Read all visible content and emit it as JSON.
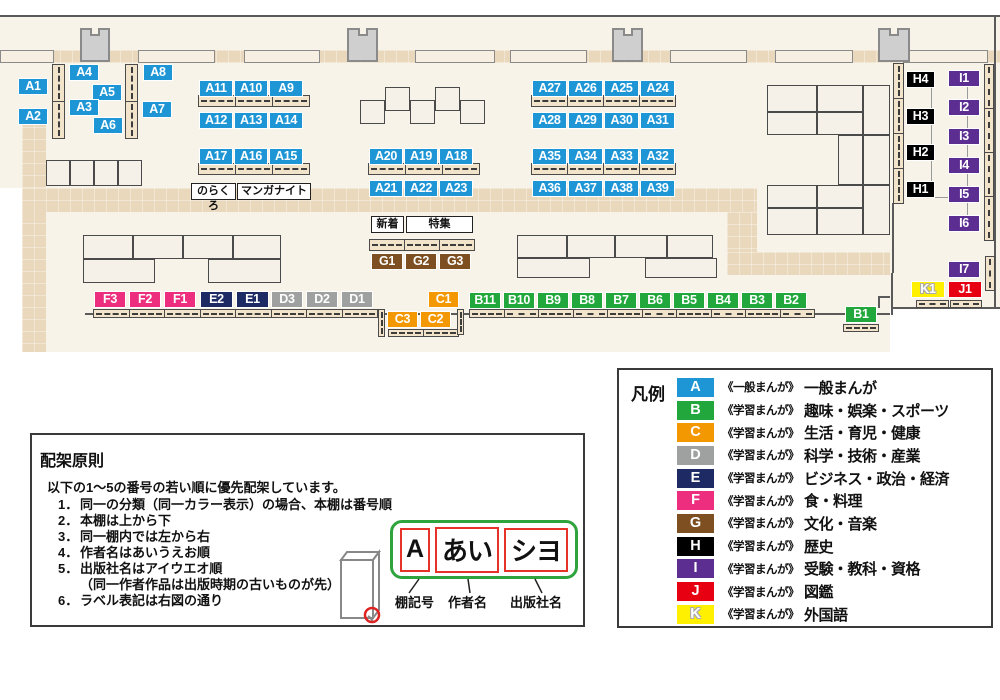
{
  "palette": {
    "A": "#1e95d5",
    "B": "#21a73c",
    "C": "#f39800",
    "D": "#9fa0a0",
    "E": "#1e2a63",
    "F": "#ed2d7d",
    "G": "#7d4f21",
    "H": "#000000",
    "I": "#5d2e91",
    "J": "#e60012",
    "K": "#fff000"
  },
  "map": {
    "shelf_labels": [
      {
        "c": "A1",
        "g": "A",
        "x": 18,
        "y": 78,
        "w": 30
      },
      {
        "c": "A2",
        "g": "A",
        "x": 18,
        "y": 108,
        "w": 30
      },
      {
        "c": "A4",
        "g": "A",
        "x": 69,
        "y": 64,
        "w": 30
      },
      {
        "c": "A5",
        "g": "A",
        "x": 92,
        "y": 84,
        "w": 30
      },
      {
        "c": "A3",
        "g": "A",
        "x": 69,
        "y": 99,
        "w": 30
      },
      {
        "c": "A6",
        "g": "A",
        "x": 93,
        "y": 117,
        "w": 30
      },
      {
        "c": "A8",
        "g": "A",
        "x": 143,
        "y": 64,
        "w": 30
      },
      {
        "c": "A7",
        "g": "A",
        "x": 142,
        "y": 101,
        "w": 30
      },
      {
        "c": "A11",
        "g": "A",
        "x": 199,
        "y": 80,
        "w": 34
      },
      {
        "c": "A10",
        "g": "A",
        "x": 234,
        "y": 80,
        "w": 34
      },
      {
        "c": "A9",
        "g": "A",
        "x": 269,
        "y": 80,
        "w": 34
      },
      {
        "c": "A12",
        "g": "A",
        "x": 199,
        "y": 112,
        "w": 34
      },
      {
        "c": "A13",
        "g": "A",
        "x": 234,
        "y": 112,
        "w": 34
      },
      {
        "c": "A14",
        "g": "A",
        "x": 269,
        "y": 112,
        "w": 34
      },
      {
        "c": "A17",
        "g": "A",
        "x": 199,
        "y": 148,
        "w": 34
      },
      {
        "c": "A16",
        "g": "A",
        "x": 234,
        "y": 148,
        "w": 34
      },
      {
        "c": "A15",
        "g": "A",
        "x": 269,
        "y": 148,
        "w": 34
      },
      {
        "c": "A20",
        "g": "A",
        "x": 369,
        "y": 148,
        "w": 34
      },
      {
        "c": "A19",
        "g": "A",
        "x": 404,
        "y": 148,
        "w": 34
      },
      {
        "c": "A18",
        "g": "A",
        "x": 439,
        "y": 148,
        "w": 34
      },
      {
        "c": "A21",
        "g": "A",
        "x": 369,
        "y": 180,
        "w": 34
      },
      {
        "c": "A22",
        "g": "A",
        "x": 404,
        "y": 180,
        "w": 34
      },
      {
        "c": "A23",
        "g": "A",
        "x": 439,
        "y": 180,
        "w": 34
      },
      {
        "c": "A27",
        "g": "A",
        "x": 532,
        "y": 80,
        "w": 35
      },
      {
        "c": "A26",
        "g": "A",
        "x": 568,
        "y": 80,
        "w": 35
      },
      {
        "c": "A25",
        "g": "A",
        "x": 604,
        "y": 80,
        "w": 35
      },
      {
        "c": "A24",
        "g": "A",
        "x": 640,
        "y": 80,
        "w": 35
      },
      {
        "c": "A28",
        "g": "A",
        "x": 532,
        "y": 112,
        "w": 35
      },
      {
        "c": "A29",
        "g": "A",
        "x": 568,
        "y": 112,
        "w": 35
      },
      {
        "c": "A30",
        "g": "A",
        "x": 604,
        "y": 112,
        "w": 35
      },
      {
        "c": "A31",
        "g": "A",
        "x": 640,
        "y": 112,
        "w": 35
      },
      {
        "c": "A35",
        "g": "A",
        "x": 532,
        "y": 148,
        "w": 35
      },
      {
        "c": "A34",
        "g": "A",
        "x": 568,
        "y": 148,
        "w": 35
      },
      {
        "c": "A33",
        "g": "A",
        "x": 604,
        "y": 148,
        "w": 35
      },
      {
        "c": "A32",
        "g": "A",
        "x": 640,
        "y": 148,
        "w": 35
      },
      {
        "c": "A36",
        "g": "A",
        "x": 532,
        "y": 180,
        "w": 35
      },
      {
        "c": "A37",
        "g": "A",
        "x": 568,
        "y": 180,
        "w": 35
      },
      {
        "c": "A38",
        "g": "A",
        "x": 604,
        "y": 180,
        "w": 35
      },
      {
        "c": "A39",
        "g": "A",
        "x": 640,
        "y": 180,
        "w": 35
      },
      {
        "c": "G1",
        "g": "G",
        "x": 371,
        "y": 253,
        "w": 32
      },
      {
        "c": "G2",
        "g": "G",
        "x": 405,
        "y": 253,
        "w": 32
      },
      {
        "c": "G3",
        "g": "G",
        "x": 439,
        "y": 253,
        "w": 32
      },
      {
        "c": "F3",
        "g": "F",
        "x": 94,
        "y": 291,
        "w": 32
      },
      {
        "c": "F2",
        "g": "F",
        "x": 129,
        "y": 291,
        "w": 32
      },
      {
        "c": "F1",
        "g": "F",
        "x": 164,
        "y": 291,
        "w": 32
      },
      {
        "c": "E2",
        "g": "E",
        "x": 200,
        "y": 291,
        "w": 33
      },
      {
        "c": "E1",
        "g": "E",
        "x": 236,
        "y": 291,
        "w": 33
      },
      {
        "c": "D3",
        "g": "D",
        "x": 271,
        "y": 291,
        "w": 32
      },
      {
        "c": "D2",
        "g": "D",
        "x": 306,
        "y": 291,
        "w": 32
      },
      {
        "c": "D1",
        "g": "D",
        "x": 341,
        "y": 291,
        "w": 32
      },
      {
        "c": "C1",
        "g": "C",
        "x": 428,
        "y": 291,
        "w": 31
      },
      {
        "c": "C3",
        "g": "C",
        "x": 387,
        "y": 311,
        "w": 31
      },
      {
        "c": "C2",
        "g": "C",
        "x": 420,
        "y": 311,
        "w": 31
      },
      {
        "c": "B11",
        "g": "B",
        "x": 469,
        "y": 292,
        "w": 32
      },
      {
        "c": "B10",
        "g": "B",
        "x": 503,
        "y": 292,
        "w": 32
      },
      {
        "c": "B9",
        "g": "B",
        "x": 537,
        "y": 292,
        "w": 32
      },
      {
        "c": "B8",
        "g": "B",
        "x": 571,
        "y": 292,
        "w": 32
      },
      {
        "c": "B7",
        "g": "B",
        "x": 605,
        "y": 292,
        "w": 32
      },
      {
        "c": "B6",
        "g": "B",
        "x": 639,
        "y": 292,
        "w": 32
      },
      {
        "c": "B5",
        "g": "B",
        "x": 673,
        "y": 292,
        "w": 32
      },
      {
        "c": "B4",
        "g": "B",
        "x": 707,
        "y": 292,
        "w": 32
      },
      {
        "c": "B3",
        "g": "B",
        "x": 741,
        "y": 292,
        "w": 32
      },
      {
        "c": "B2",
        "g": "B",
        "x": 775,
        "y": 292,
        "w": 32
      },
      {
        "c": "B1",
        "g": "B",
        "x": 845,
        "y": 306,
        "w": 32
      },
      {
        "c": "H4",
        "g": "H",
        "x": 906,
        "y": 71,
        "w": 29
      },
      {
        "c": "H3",
        "g": "H",
        "x": 906,
        "y": 108,
        "w": 29
      },
      {
        "c": "H2",
        "g": "H",
        "x": 906,
        "y": 144,
        "w": 29
      },
      {
        "c": "H1",
        "g": "H",
        "x": 906,
        "y": 181,
        "w": 29
      },
      {
        "c": "I1",
        "g": "I",
        "x": 948,
        "y": 70,
        "w": 32
      },
      {
        "c": "I2",
        "g": "I",
        "x": 948,
        "y": 99,
        "w": 32
      },
      {
        "c": "I3",
        "g": "I",
        "x": 948,
        "y": 128,
        "w": 32
      },
      {
        "c": "I4",
        "g": "I",
        "x": 948,
        "y": 157,
        "w": 32
      },
      {
        "c": "I5",
        "g": "I",
        "x": 948,
        "y": 186,
        "w": 32
      },
      {
        "c": "I6",
        "g": "I",
        "x": 948,
        "y": 215,
        "w": 32
      },
      {
        "c": "I7",
        "g": "I",
        "x": 948,
        "y": 261,
        "w": 32
      },
      {
        "c": "K1",
        "g": "K",
        "x": 911,
        "y": 281,
        "w": 34
      },
      {
        "c": "J1",
        "g": "J",
        "x": 948,
        "y": 281,
        "w": 34
      }
    ],
    "area_labels": [
      {
        "text": "のらくろ",
        "x": 191,
        "y": 183,
        "w": 45
      },
      {
        "text": "マンガナイト",
        "x": 237,
        "y": 183,
        "w": 74
      },
      {
        "text": "新着",
        "x": 371,
        "y": 216,
        "w": 33
      },
      {
        "text": "特集",
        "x": 406,
        "y": 216,
        "w": 67
      }
    ]
  },
  "legend": {
    "title": "凡例",
    "items": [
      {
        "code": "A",
        "series": "《一般まんが》",
        "category": "一般まんが"
      },
      {
        "code": "B",
        "series": "《学習まんが》",
        "category": "趣味・娯楽・スポーツ"
      },
      {
        "code": "C",
        "series": "《学習まんが》",
        "category": "生活・育児・健康"
      },
      {
        "code": "D",
        "series": "《学習まんが》",
        "category": "科学・技術・産業"
      },
      {
        "code": "E",
        "series": "《学習まんが》",
        "category": "ビジネス・政治・経済"
      },
      {
        "code": "F",
        "series": "《学習まんが》",
        "category": "食・料理"
      },
      {
        "code": "G",
        "series": "《学習まんが》",
        "category": "文化・音楽"
      },
      {
        "code": "H",
        "series": "《学習まんが》",
        "category": "歴史"
      },
      {
        "code": "I",
        "series": "《学習まんが》",
        "category": "受験・教科・資格"
      },
      {
        "code": "J",
        "series": "《学習まんが》",
        "category": "図鑑"
      },
      {
        "code": "K",
        "series": "《学習まんが》",
        "category": "外国語"
      }
    ]
  },
  "principles": {
    "title": "配架原則",
    "intro": "以下の1～5の番号の若い順に優先配架しています。",
    "items": [
      {
        "num": "1．",
        "text": "同一の分類（同一カラー表示）の場合、本棚は番号順"
      },
      {
        "num": "2．",
        "text": "本棚は上から下"
      },
      {
        "num": "3．",
        "text": "同一棚内では左から右"
      },
      {
        "num": "4．",
        "text": "作者名はあいうえお順"
      },
      {
        "num": "5．",
        "text": "出版社名はアイウエオ順"
      },
      {
        "num": "",
        "text": "（同一作者作品は出版時期の古いものが先）"
      },
      {
        "num": "6．",
        "text": "ラベル表記は右図の通り"
      }
    ],
    "diagram": {
      "boxes": [
        "A",
        "あい",
        "シヨ"
      ],
      "captions": [
        "棚記号",
        "作者名",
        "出版社名"
      ]
    }
  }
}
